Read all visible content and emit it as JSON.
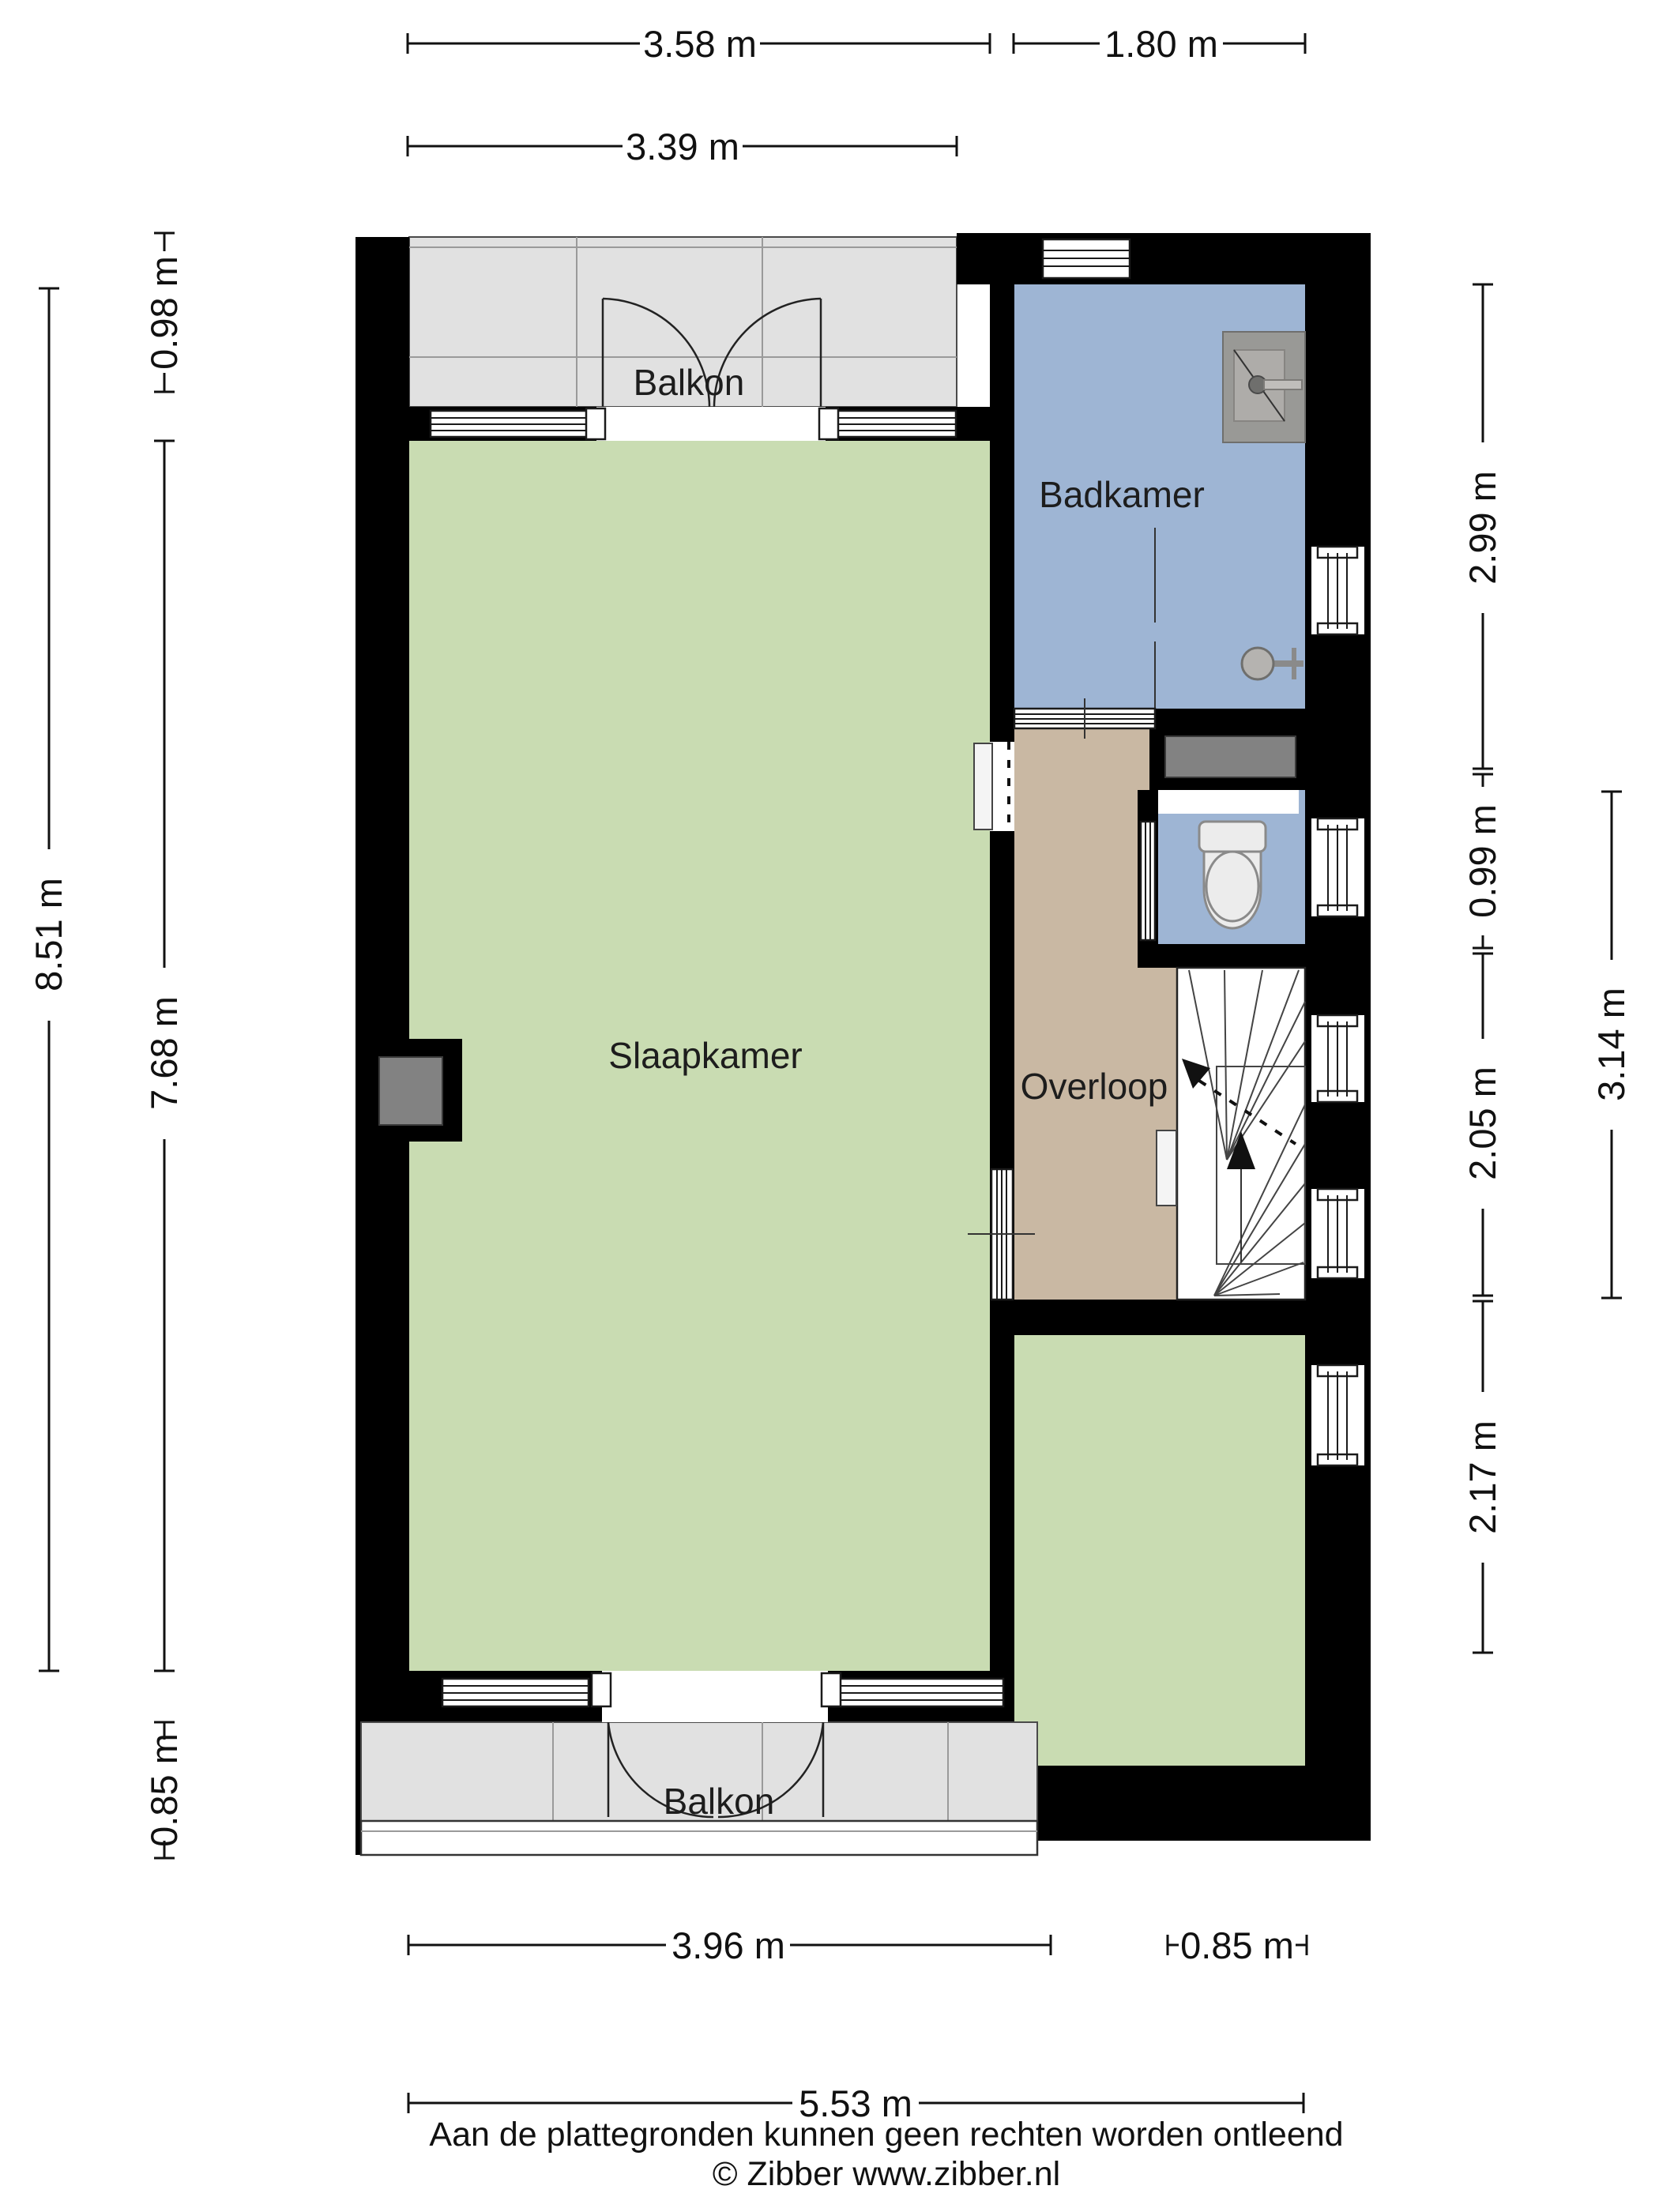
{
  "rooms": {
    "balcony_top": {
      "label": "Balkon"
    },
    "bathroom": {
      "label": "Badkamer"
    },
    "bedroom": {
      "label": "Slaapkamer"
    },
    "landing": {
      "label": "Overloop"
    },
    "balcony_bottom": {
      "label": "Balkon"
    }
  },
  "dimensions": {
    "top_358": "3.58 m",
    "top_180": "1.80 m",
    "top_339": "3.39 m",
    "left_098": "0.98 m",
    "left_851": "8.51 m",
    "left_768": "7.68 m",
    "left_085": "0.85 m",
    "right_299": "2.99 m",
    "right_099": "0.99 m",
    "right_205": "2.05 m",
    "right_314": "3.14 m",
    "right_217": "2.17 m",
    "bottom_396": "3.96 m",
    "bottom_085": "0.85 m",
    "bottom_553": "5.53 m"
  },
  "footer": {
    "disclaimer": "Aan de plattegronden kunnen geen rechten worden ontleend",
    "copyright": "© Zibber www.zibber.nl"
  },
  "colors": {
    "bedroom": "#c9dcb2",
    "bathroom": "#9eb5d4",
    "landing": "#c9b8a3",
    "balcony": "#e1e1e1",
    "wall": "#000000"
  }
}
